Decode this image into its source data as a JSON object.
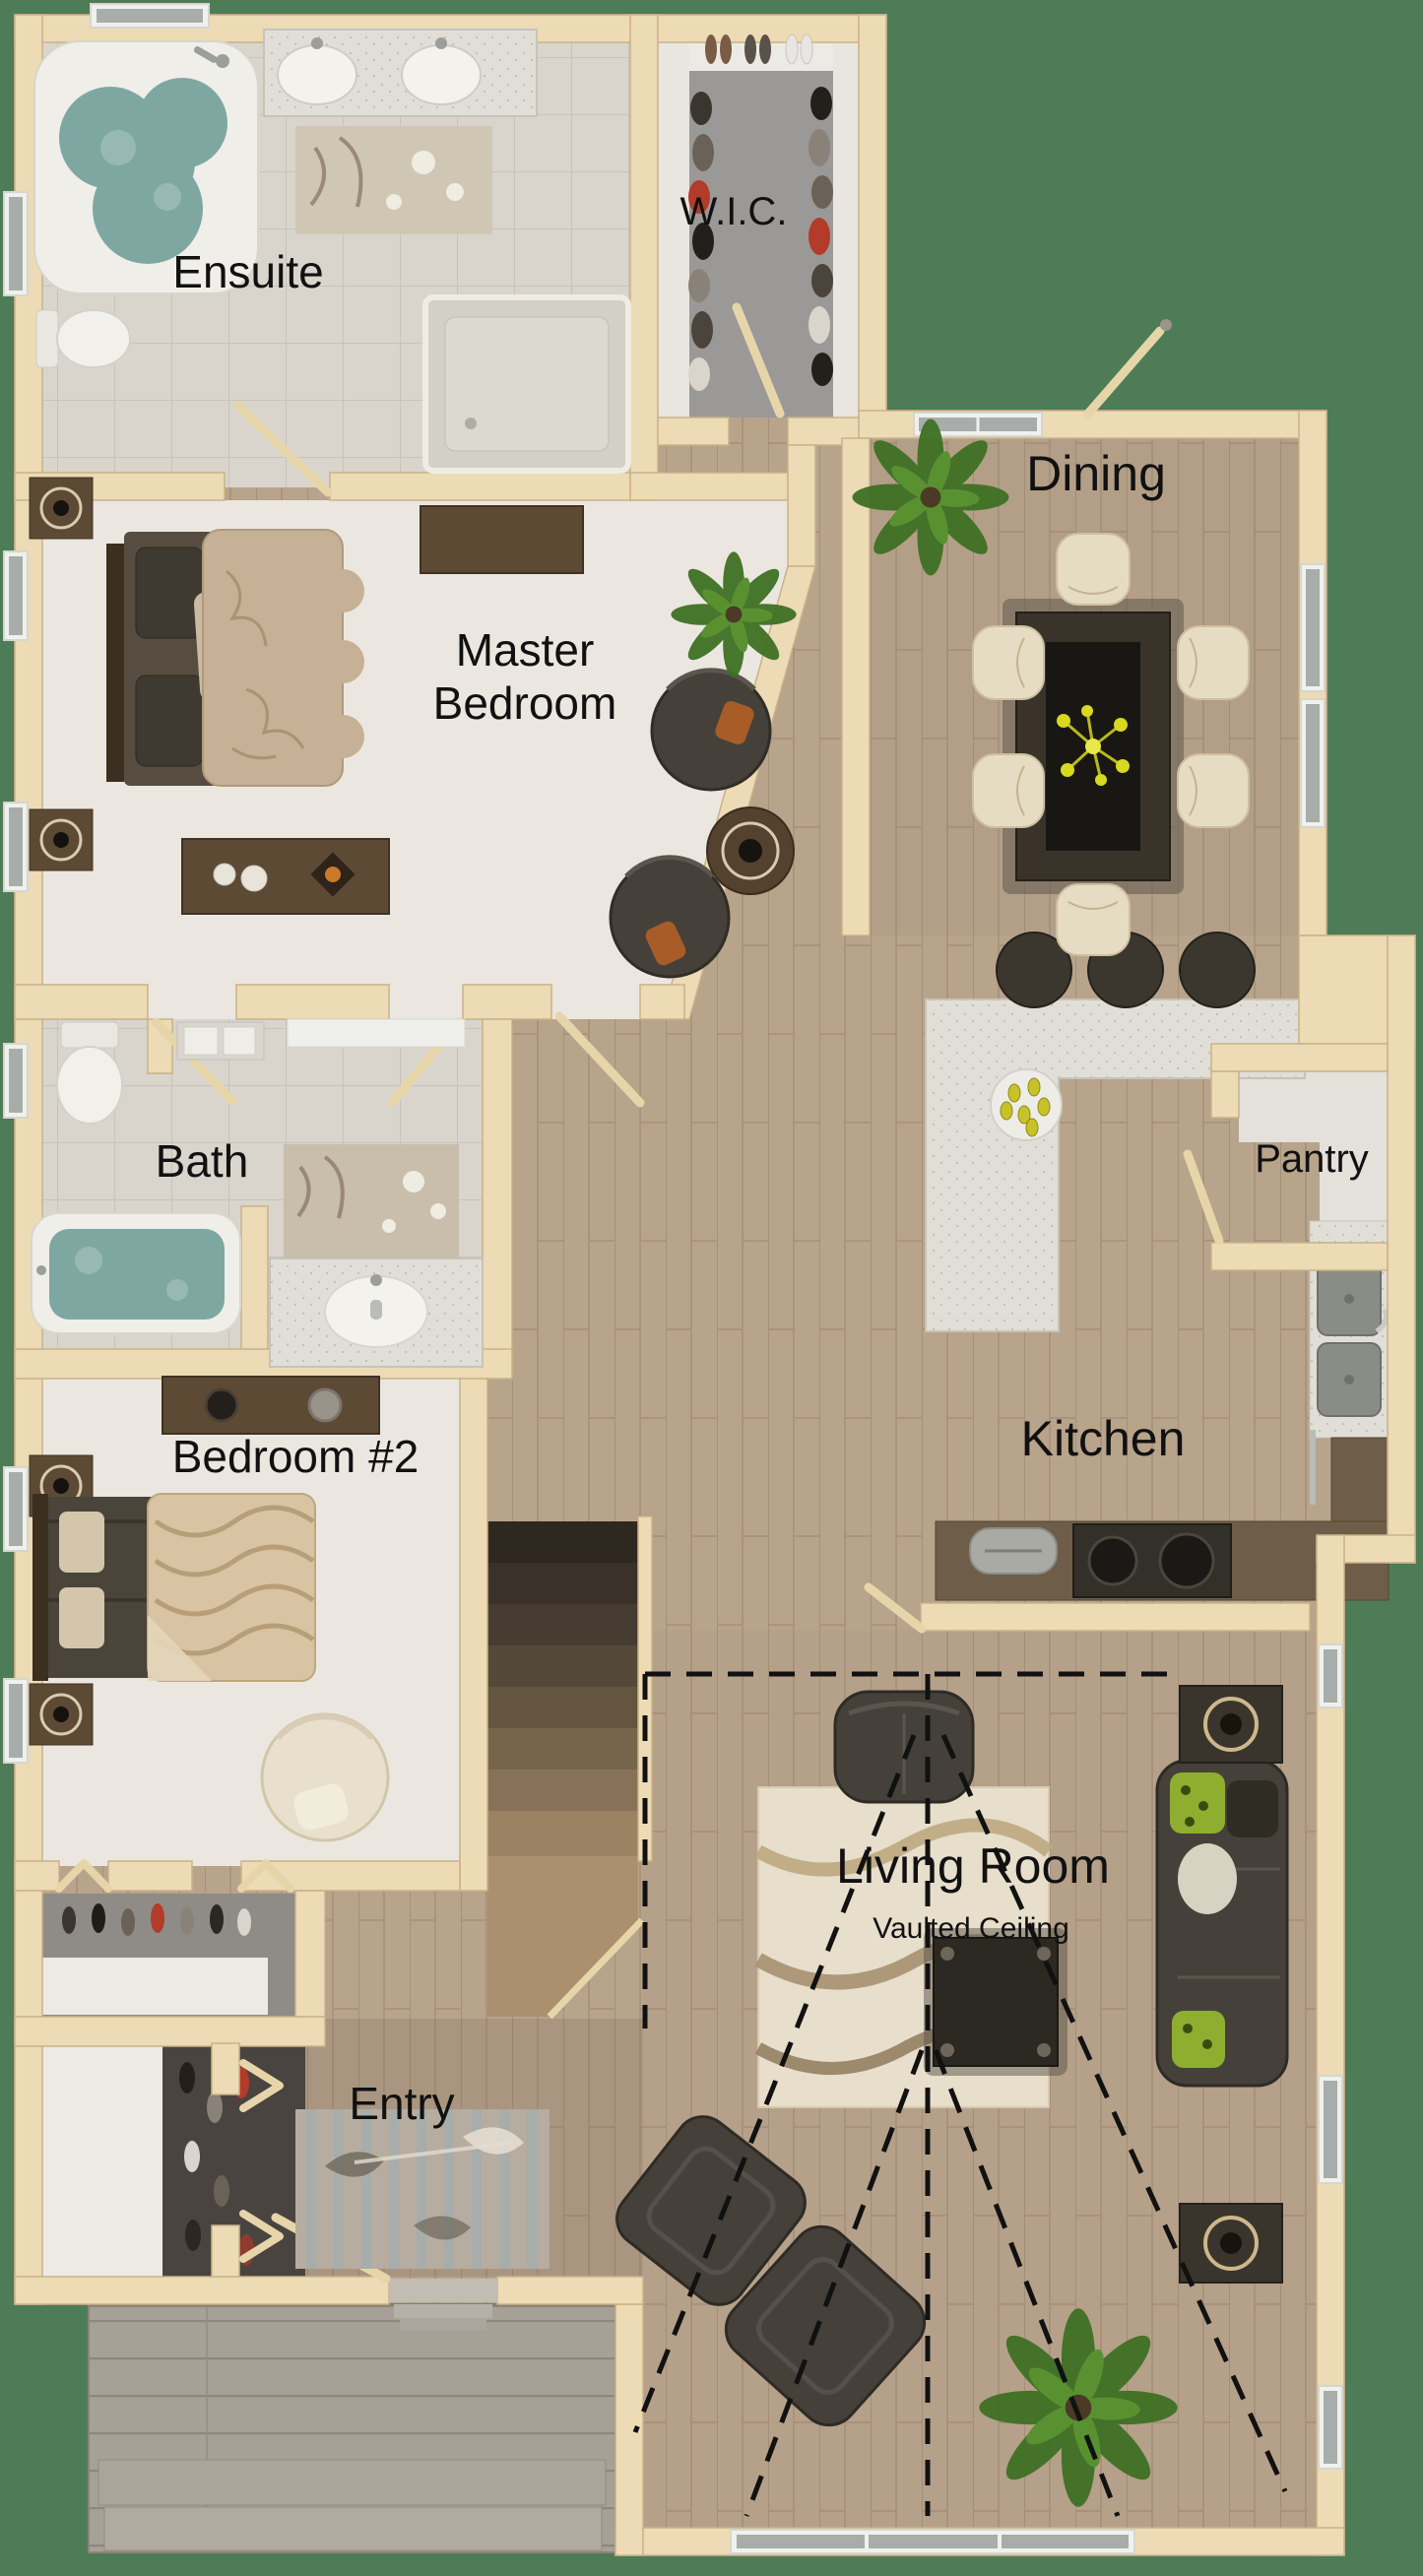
{
  "title": "Main floor plan (3D top-down rendering)",
  "background_color": "#4d7c57",
  "palette": {
    "bg": "#4d7c57",
    "label": "#111111",
    "wall": "#ecdbb4",
    "wood_floor": "#b8a38b",
    "tile_floor": "#d9d5cd",
    "carpet": "#ebe7e0",
    "wic_carpet": "#9b9997",
    "deck": "#a6a096",
    "counter": "#e0ded6",
    "dark_wood": "#5d4a35",
    "furniture_dark": "#45413a",
    "furniture_cream": "#e6dcc3",
    "water": "#7fa7a2"
  },
  "rooms": {
    "ensuite": {
      "label": "Ensuite",
      "furniture": [
        "corner-jacuzzi-tub",
        "double-sink-vanity",
        "toilet",
        "shower",
        "rug"
      ]
    },
    "wic": {
      "label": "W.I.C.",
      "furniture": [
        "shoe-row",
        "hanging-clothes",
        "shelves"
      ]
    },
    "dining": {
      "label": "Dining",
      "furniture": [
        "dining-table",
        "six-chairs",
        "flower-centerpiece",
        "palm-plant"
      ]
    },
    "master_bedroom": {
      "label": "Master Bedroom",
      "label_line1": "Master",
      "label_line2": "Bedroom",
      "furniture": [
        "double-bed",
        "nightstands",
        "dresser",
        "bench-with-cups",
        "two-round-chairs",
        "round-side-table",
        "plant"
      ]
    },
    "bath": {
      "label": "Bath",
      "furniture": [
        "toilet",
        "bathtub",
        "vanity-sink",
        "towel-shelf",
        "rug"
      ]
    },
    "pantry": {
      "label": "Pantry",
      "furniture": []
    },
    "kitchen": {
      "label": "Kitchen",
      "furniture": [
        "l-shaped-island",
        "bar-stools",
        "fruit-plate",
        "double-sink",
        "stove",
        "toaster",
        "counters"
      ]
    },
    "bedroom2": {
      "label": "Bedroom #2",
      "furniture": [
        "double-bed",
        "nightstands",
        "dresser",
        "round-chair",
        "closet"
      ]
    },
    "living_room": {
      "label": "Living Room",
      "sublabel": "Vaulted Ceiling",
      "furniture": [
        "sofa",
        "loveseat",
        "two-armchairs",
        "coffee-table",
        "side-tables",
        "area-rug",
        "plant"
      ]
    },
    "entry": {
      "label": "Entry",
      "furniture": [
        "coat-closet",
        "rug",
        "front-door",
        "stairs"
      ]
    },
    "outdoor": {
      "label": "",
      "furniture": [
        "deck",
        "deck-steps"
      ]
    }
  }
}
